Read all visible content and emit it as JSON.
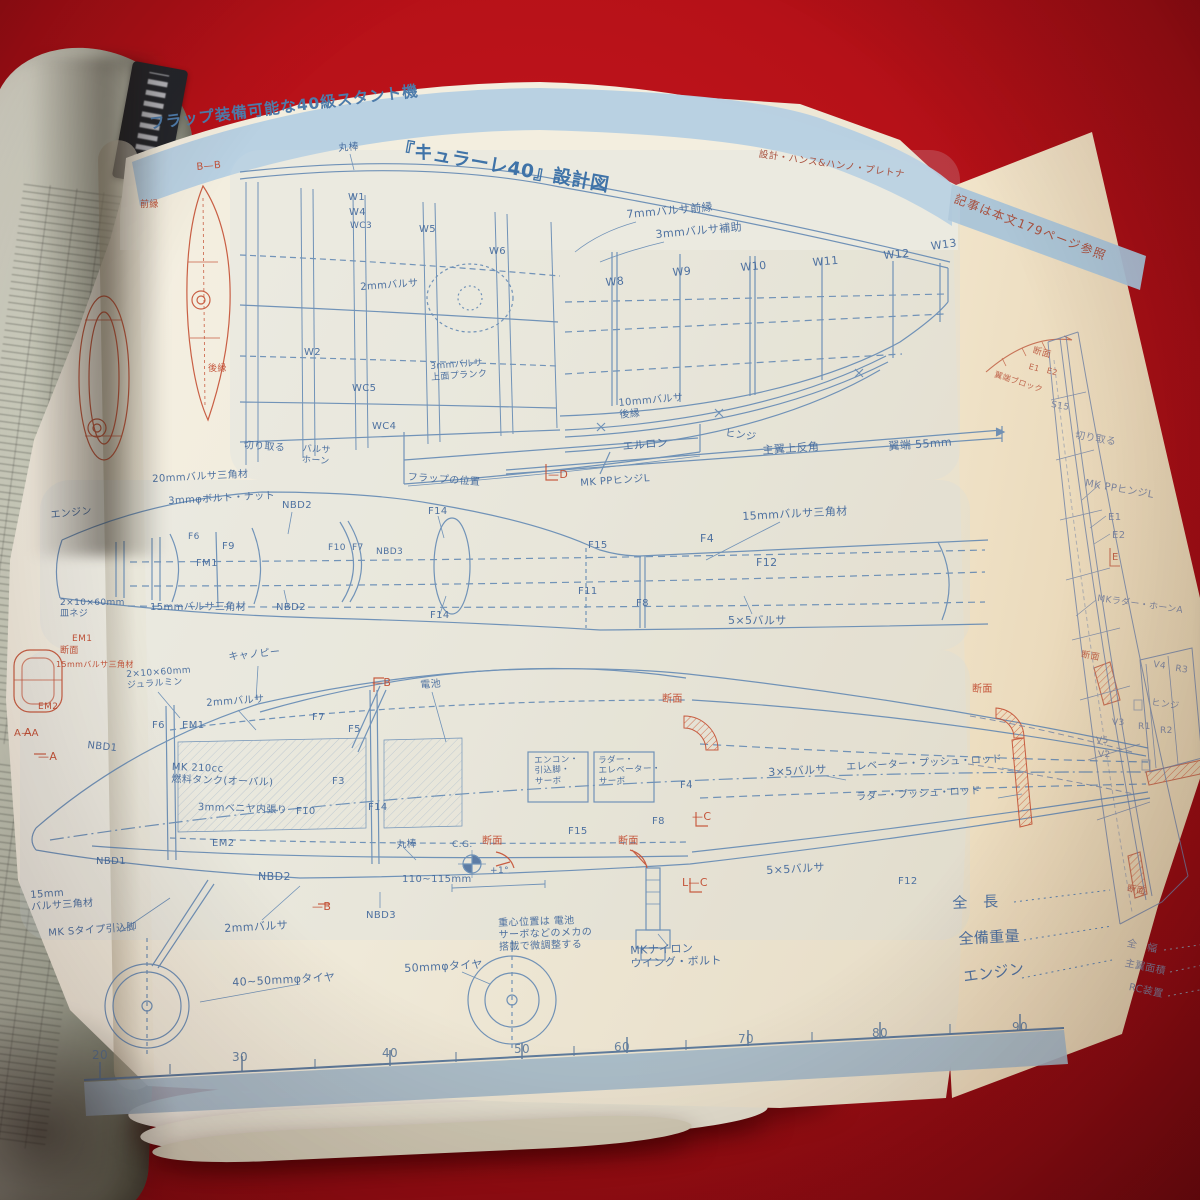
{
  "header": {
    "title_prefix": "フラップ装備可能な40級スタント機",
    "title_main": "『キュラーレ40』設計図",
    "credit": "設計・ハンス&ハンノ・プレトナ",
    "side_note": "記事は本文179ページ参照"
  },
  "colors": {
    "background_red": "#b61118",
    "band_blue": "#b5cfe1",
    "line_blue": "#5b83b1",
    "line_red": "#c44f33",
    "paper": "#f2ecdc",
    "back_paper": "#eee0c4"
  },
  "ruler": {
    "unit_numbers": [
      "20",
      "30",
      "40",
      "50",
      "60",
      "70",
      "80",
      "90"
    ]
  },
  "blueprint": {
    "labels": [
      {
        "t": "丸棒",
        "x": 338,
        "y": 143,
        "s": 10,
        "r": -4
      },
      {
        "t": "W1",
        "x": 348,
        "y": 192,
        "s": 10
      },
      {
        "t": "W4",
        "x": 349,
        "y": 207,
        "s": 10
      },
      {
        "t": "WC3",
        "x": 350,
        "y": 221,
        "s": 9
      },
      {
        "t": "W5",
        "x": 419,
        "y": 224,
        "s": 10
      },
      {
        "t": "W6",
        "x": 489,
        "y": 246,
        "s": 10
      },
      {
        "t": "W2",
        "x": 304,
        "y": 347,
        "s": 10
      },
      {
        "t": "WC5",
        "x": 352,
        "y": 383,
        "s": 10
      },
      {
        "t": "WC4",
        "x": 372,
        "y": 421,
        "s": 10
      },
      {
        "t": "切り取る",
        "x": 244,
        "y": 440,
        "s": 10,
        "r": 4
      },
      {
        "t": "バルサ\nホーン",
        "x": 303,
        "y": 444,
        "s": 9,
        "r": 4
      },
      {
        "t": "フラップの位置",
        "x": 408,
        "y": 472,
        "s": 10,
        "r": 4
      },
      {
        "t": "2mmバルサ",
        "x": 360,
        "y": 282,
        "s": 10,
        "r": -4
      },
      {
        "t": "3mmバルサ\n上面プランク",
        "x": 430,
        "y": 362,
        "s": 9,
        "r": -4
      },
      {
        "t": "7mmバルサ前縁",
        "x": 626,
        "y": 208,
        "s": 11,
        "r": -5
      },
      {
        "t": "3mmバルサ補助",
        "x": 655,
        "y": 228,
        "s": 11,
        "r": -5
      },
      {
        "t": "W8",
        "x": 605,
        "y": 276,
        "s": 11,
        "r": -5
      },
      {
        "t": "W9",
        "x": 672,
        "y": 266,
        "s": 11,
        "r": -5
      },
      {
        "t": "W10",
        "x": 740,
        "y": 261,
        "s": 11,
        "r": -5
      },
      {
        "t": "W11",
        "x": 812,
        "y": 256,
        "s": 11,
        "r": -5
      },
      {
        "t": "W12",
        "x": 883,
        "y": 249,
        "s": 11,
        "r": -5
      },
      {
        "t": "W13",
        "x": 930,
        "y": 240,
        "s": 11,
        "r": -8
      },
      {
        "t": "10mmバルサ\n後縁",
        "x": 618,
        "y": 398,
        "s": 10,
        "r": -5
      },
      {
        "t": "エルロン",
        "x": 622,
        "y": 440,
        "s": 11,
        "r": -5
      },
      {
        "t": "ヒンジ",
        "x": 726,
        "y": 428,
        "s": 10,
        "r": 8
      },
      {
        "t": "主翼上反角",
        "x": 762,
        "y": 444,
        "s": 11,
        "r": -4
      },
      {
        "t": "翼端 55mm",
        "x": 888,
        "y": 440,
        "s": 11,
        "r": -4
      },
      {
        "t": "MK PPヒンジL",
        "x": 580,
        "y": 478,
        "s": 10,
        "r": -4
      },
      {
        "t": "—D",
        "x": 548,
        "y": 468,
        "s": 11,
        "c": "r"
      },
      {
        "t": "エンジン",
        "x": 50,
        "y": 510,
        "s": 10,
        "r": -6
      },
      {
        "t": "20mmバルサ三角材",
        "x": 152,
        "y": 474,
        "s": 10,
        "r": -3
      },
      {
        "t": "3mmφボルト・ナット",
        "x": 168,
        "y": 496,
        "s": 10,
        "r": -3
      },
      {
        "t": "NBD2",
        "x": 282,
        "y": 500,
        "s": 10
      },
      {
        "t": "F14",
        "x": 428,
        "y": 506,
        "s": 10
      },
      {
        "t": "F6",
        "x": 188,
        "y": 532,
        "s": 9
      },
      {
        "t": "F9",
        "x": 222,
        "y": 541,
        "s": 10
      },
      {
        "t": "FM1",
        "x": 196,
        "y": 558,
        "s": 10
      },
      {
        "t": "F10",
        "x": 328,
        "y": 543,
        "s": 9
      },
      {
        "t": "F7",
        "x": 352,
        "y": 543,
        "s": 9
      },
      {
        "t": "NBD3",
        "x": 376,
        "y": 547,
        "s": 9
      },
      {
        "t": "15mmバルサ三角材",
        "x": 150,
        "y": 602,
        "s": 10
      },
      {
        "t": "NBD2",
        "x": 276,
        "y": 602,
        "s": 10
      },
      {
        "t": "F14",
        "x": 430,
        "y": 610,
        "s": 10
      },
      {
        "t": "2×10×60mm\n皿ネジ",
        "x": 60,
        "y": 598,
        "s": 9
      },
      {
        "t": "15mmバルサ三角材",
        "x": 742,
        "y": 510,
        "s": 11,
        "r": -3
      },
      {
        "t": "F4",
        "x": 700,
        "y": 532,
        "s": 11
      },
      {
        "t": "F15",
        "x": 588,
        "y": 540,
        "s": 10
      },
      {
        "t": "F12",
        "x": 756,
        "y": 556,
        "s": 11
      },
      {
        "t": "F11",
        "x": 578,
        "y": 586,
        "s": 10
      },
      {
        "t": "F8",
        "x": 636,
        "y": 598,
        "s": 10
      },
      {
        "t": "5×5バルサ",
        "x": 728,
        "y": 614,
        "s": 11
      },
      {
        "t": "キャノピー",
        "x": 228,
        "y": 652,
        "s": 10,
        "r": -6
      },
      {
        "t": "2×10×60mm\nジュラルミン",
        "x": 126,
        "y": 670,
        "s": 9,
        "r": -4
      },
      {
        "t": "2mmバルサ",
        "x": 206,
        "y": 698,
        "s": 10,
        "r": -4
      },
      {
        "t": "F6",
        "x": 152,
        "y": 720,
        "s": 10
      },
      {
        "t": "EM1",
        "x": 182,
        "y": 720,
        "s": 10
      },
      {
        "t": "F7",
        "x": 312,
        "y": 712,
        "s": 10
      },
      {
        "t": "F5",
        "x": 348,
        "y": 724,
        "s": 10
      },
      {
        "t": "電池",
        "x": 420,
        "y": 680,
        "s": 10,
        "r": -4
      },
      {
        "t": "—B",
        "x": 372,
        "y": 676,
        "s": 11,
        "c": "r"
      },
      {
        "t": "A",
        "x": 24,
        "y": 726,
        "s": 11,
        "c": "r"
      },
      {
        "t": "—A",
        "x": 38,
        "y": 750,
        "s": 11,
        "c": "r"
      },
      {
        "t": "NBD1",
        "x": 88,
        "y": 740,
        "s": 10,
        "r": 6
      },
      {
        "t": "MK 210cc\n燃料タンク(オーバル)",
        "x": 172,
        "y": 762,
        "s": 10,
        "r": 2
      },
      {
        "t": "3mmベニヤ内張り",
        "x": 198,
        "y": 802,
        "s": 10,
        "r": 2
      },
      {
        "t": "F10",
        "x": 296,
        "y": 806,
        "s": 10
      },
      {
        "t": "F3",
        "x": 332,
        "y": 776,
        "s": 10
      },
      {
        "t": "F14",
        "x": 368,
        "y": 802,
        "s": 10
      },
      {
        "t": "EM1",
        "x": 72,
        "y": 634,
        "s": 9,
        "c": "r"
      },
      {
        "t": "断面",
        "x": 60,
        "y": 646,
        "s": 9,
        "c": "r"
      },
      {
        "t": "15mmバルサ三角材",
        "x": 56,
        "y": 660,
        "s": 8,
        "c": "r"
      },
      {
        "t": "EM2",
        "x": 38,
        "y": 702,
        "s": 9,
        "c": "r"
      },
      {
        "t": "A—A",
        "x": 14,
        "y": 728,
        "s": 10,
        "c": "r"
      },
      {
        "t": "エンコン・\n引込脚・\nサーボ",
        "x": 534,
        "y": 756,
        "s": 8.5,
        "r": -2
      },
      {
        "t": "ラダー・\nエレベーター・\nサーボ",
        "x": 598,
        "y": 756,
        "s": 8.5,
        "r": -2
      },
      {
        "t": "NBD1",
        "x": 96,
        "y": 856,
        "s": 10
      },
      {
        "t": "EM2",
        "x": 212,
        "y": 838,
        "s": 10
      },
      {
        "t": "NBD2",
        "x": 258,
        "y": 870,
        "s": 11
      },
      {
        "t": "丸棒",
        "x": 396,
        "y": 840,
        "s": 10,
        "r": -4
      },
      {
        "t": "110~115mm",
        "x": 402,
        "y": 874,
        "s": 10
      },
      {
        "t": "15mm\nバルサ三角材",
        "x": 30,
        "y": 890,
        "s": 10,
        "r": -4
      },
      {
        "t": "MK Sタイプ引込脚",
        "x": 48,
        "y": 928,
        "s": 10,
        "r": -4
      },
      {
        "t": "2mmバルサ",
        "x": 224,
        "y": 922,
        "s": 11,
        "r": -3
      },
      {
        "t": "—B",
        "x": 312,
        "y": 900,
        "s": 11,
        "c": "r"
      },
      {
        "t": "NBD3",
        "x": 366,
        "y": 910,
        "s": 10
      },
      {
        "t": "40~50mmφタイヤ",
        "x": 232,
        "y": 976,
        "s": 11,
        "r": -3
      },
      {
        "t": "50mmφタイヤ",
        "x": 404,
        "y": 962,
        "s": 11,
        "r": -3
      },
      {
        "t": "C.G.",
        "x": 452,
        "y": 840,
        "s": 9
      },
      {
        "t": "+1°",
        "x": 490,
        "y": 866,
        "s": 9
      },
      {
        "t": "断面",
        "x": 482,
        "y": 836,
        "s": 10,
        "c": "r"
      },
      {
        "t": "F15",
        "x": 568,
        "y": 826,
        "s": 10
      },
      {
        "t": "断面",
        "x": 618,
        "y": 836,
        "s": 10,
        "c": "r"
      },
      {
        "t": "L—C",
        "x": 682,
        "y": 876,
        "s": 11,
        "c": "r"
      },
      {
        "t": "5×5バルサ",
        "x": 766,
        "y": 864,
        "s": 11,
        "r": -3
      },
      {
        "t": "重心位置は 電池\nサーボなどのメカの\n搭載で微調整する",
        "x": 498,
        "y": 918,
        "s": 10,
        "r": -2
      },
      {
        "t": "MKナイロン\nウイング・ボルト",
        "x": 630,
        "y": 944,
        "s": 11,
        "r": -2
      },
      {
        "t": "断面",
        "x": 662,
        "y": 694,
        "s": 10,
        "c": "r"
      },
      {
        "t": "断面",
        "x": 972,
        "y": 684,
        "s": 10,
        "c": "r"
      },
      {
        "t": "3×5バルサ",
        "x": 768,
        "y": 766,
        "s": 11,
        "r": -3
      },
      {
        "t": "エレベーター・プッシュ・ロッド",
        "x": 846,
        "y": 762,
        "s": 10,
        "r": -3
      },
      {
        "t": "ラダー・プッシュ・ロッド",
        "x": 856,
        "y": 792,
        "s": 10,
        "r": -3
      },
      {
        "t": "F4",
        "x": 680,
        "y": 780,
        "s": 10
      },
      {
        "t": "F8",
        "x": 652,
        "y": 816,
        "s": 10
      },
      {
        "t": "—C",
        "x": 692,
        "y": 810,
        "s": 11,
        "c": "r"
      },
      {
        "t": "F12",
        "x": 898,
        "y": 876,
        "s": 10
      },
      {
        "t": "全　長",
        "x": 952,
        "y": 894,
        "s": 15,
        "r": -2
      },
      {
        "t": "全備重量",
        "x": 958,
        "y": 930,
        "s": 15,
        "r": -3
      },
      {
        "t": "エンジン",
        "x": 962,
        "y": 968,
        "s": 15,
        "r": -8
      },
      {
        "t": "断面",
        "x": 1128,
        "y": 884,
        "s": 9,
        "c": "mr",
        "r": 10
      },
      {
        "t": "全　幅",
        "x": 1128,
        "y": 938,
        "s": 10,
        "c": "mb",
        "r": 12
      },
      {
        "t": "主翼面積",
        "x": 1126,
        "y": 958,
        "s": 10,
        "c": "mb",
        "r": 12
      },
      {
        "t": "RC装置",
        "x": 1130,
        "y": 982,
        "s": 10,
        "c": "mb",
        "r": 12
      },
      {
        "t": "断面",
        "x": 1034,
        "y": 346,
        "s": 9,
        "c": "mr",
        "r": 15
      },
      {
        "t": "E1",
        "x": 1030,
        "y": 362,
        "s": 8,
        "c": "mr",
        "r": 15
      },
      {
        "t": "E2",
        "x": 1048,
        "y": 366,
        "s": 8,
        "c": "mr",
        "r": 15
      },
      {
        "t": "翼端ブロック",
        "x": 996,
        "y": 370,
        "s": 8,
        "c": "mr",
        "r": 18
      },
      {
        "t": "S15",
        "x": 1052,
        "y": 400,
        "s": 9,
        "c": "mb",
        "r": 10
      },
      {
        "t": "切り取る",
        "x": 1076,
        "y": 430,
        "s": 10,
        "c": "mb",
        "r": 10
      },
      {
        "t": "MK PPヒンジL",
        "x": 1086,
        "y": 478,
        "s": 10,
        "c": "mb",
        "r": 10
      },
      {
        "t": "E1",
        "x": 1108,
        "y": 512,
        "s": 10,
        "c": "mb"
      },
      {
        "t": "E2",
        "x": 1112,
        "y": 530,
        "s": 10,
        "c": "mb"
      },
      {
        "t": "E",
        "x": 1112,
        "y": 552,
        "s": 10,
        "c": "mr"
      },
      {
        "t": "MKラダー・ホーンA",
        "x": 1098,
        "y": 594,
        "s": 9,
        "c": "mb",
        "r": 8
      },
      {
        "t": "断面",
        "x": 1082,
        "y": 650,
        "s": 9,
        "c": "mr",
        "r": 10
      },
      {
        "t": "V4",
        "x": 1154,
        "y": 660,
        "s": 9,
        "c": "mb",
        "r": 8
      },
      {
        "t": "R3",
        "x": 1176,
        "y": 664,
        "s": 9,
        "c": "mb",
        "r": 8
      },
      {
        "t": "ヒンジ",
        "x": 1152,
        "y": 698,
        "s": 9,
        "c": "mb",
        "r": 8
      },
      {
        "t": "V3",
        "x": 1112,
        "y": 718,
        "s": 9,
        "c": "mb"
      },
      {
        "t": "R1",
        "x": 1138,
        "y": 722,
        "s": 9,
        "c": "mb"
      },
      {
        "t": "R2",
        "x": 1160,
        "y": 726,
        "s": 9,
        "c": "mb"
      },
      {
        "t": "V5",
        "x": 1096,
        "y": 736,
        "s": 9,
        "c": "mb"
      },
      {
        "t": "V2",
        "x": 1098,
        "y": 750,
        "s": 9,
        "c": "mb"
      },
      {
        "t": "B—B",
        "x": 196,
        "y": 162,
        "s": 10,
        "c": "r",
        "r": -5
      },
      {
        "t": "前縁",
        "x": 140,
        "y": 200,
        "s": 9,
        "c": "r"
      },
      {
        "t": "後縁",
        "x": 208,
        "y": 364,
        "s": 9,
        "c": "r"
      },
      {
        "t": "20",
        "x": 92,
        "y": 1048,
        "s": 12,
        "c": "g"
      },
      {
        "t": "30",
        "x": 232,
        "y": 1050,
        "s": 12,
        "c": "g"
      },
      {
        "t": "40",
        "x": 382,
        "y": 1046,
        "s": 12,
        "c": "g"
      },
      {
        "t": "50",
        "x": 514,
        "y": 1042,
        "s": 12,
        "c": "g"
      },
      {
        "t": "60",
        "x": 614,
        "y": 1040,
        "s": 12,
        "c": "g"
      },
      {
        "t": "70",
        "x": 738,
        "y": 1032,
        "s": 12,
        "c": "g"
      },
      {
        "t": "80",
        "x": 872,
        "y": 1026,
        "s": 12,
        "c": "g"
      },
      {
        "t": "90",
        "x": 1012,
        "y": 1020,
        "s": 12,
        "c": "g"
      }
    ]
  }
}
